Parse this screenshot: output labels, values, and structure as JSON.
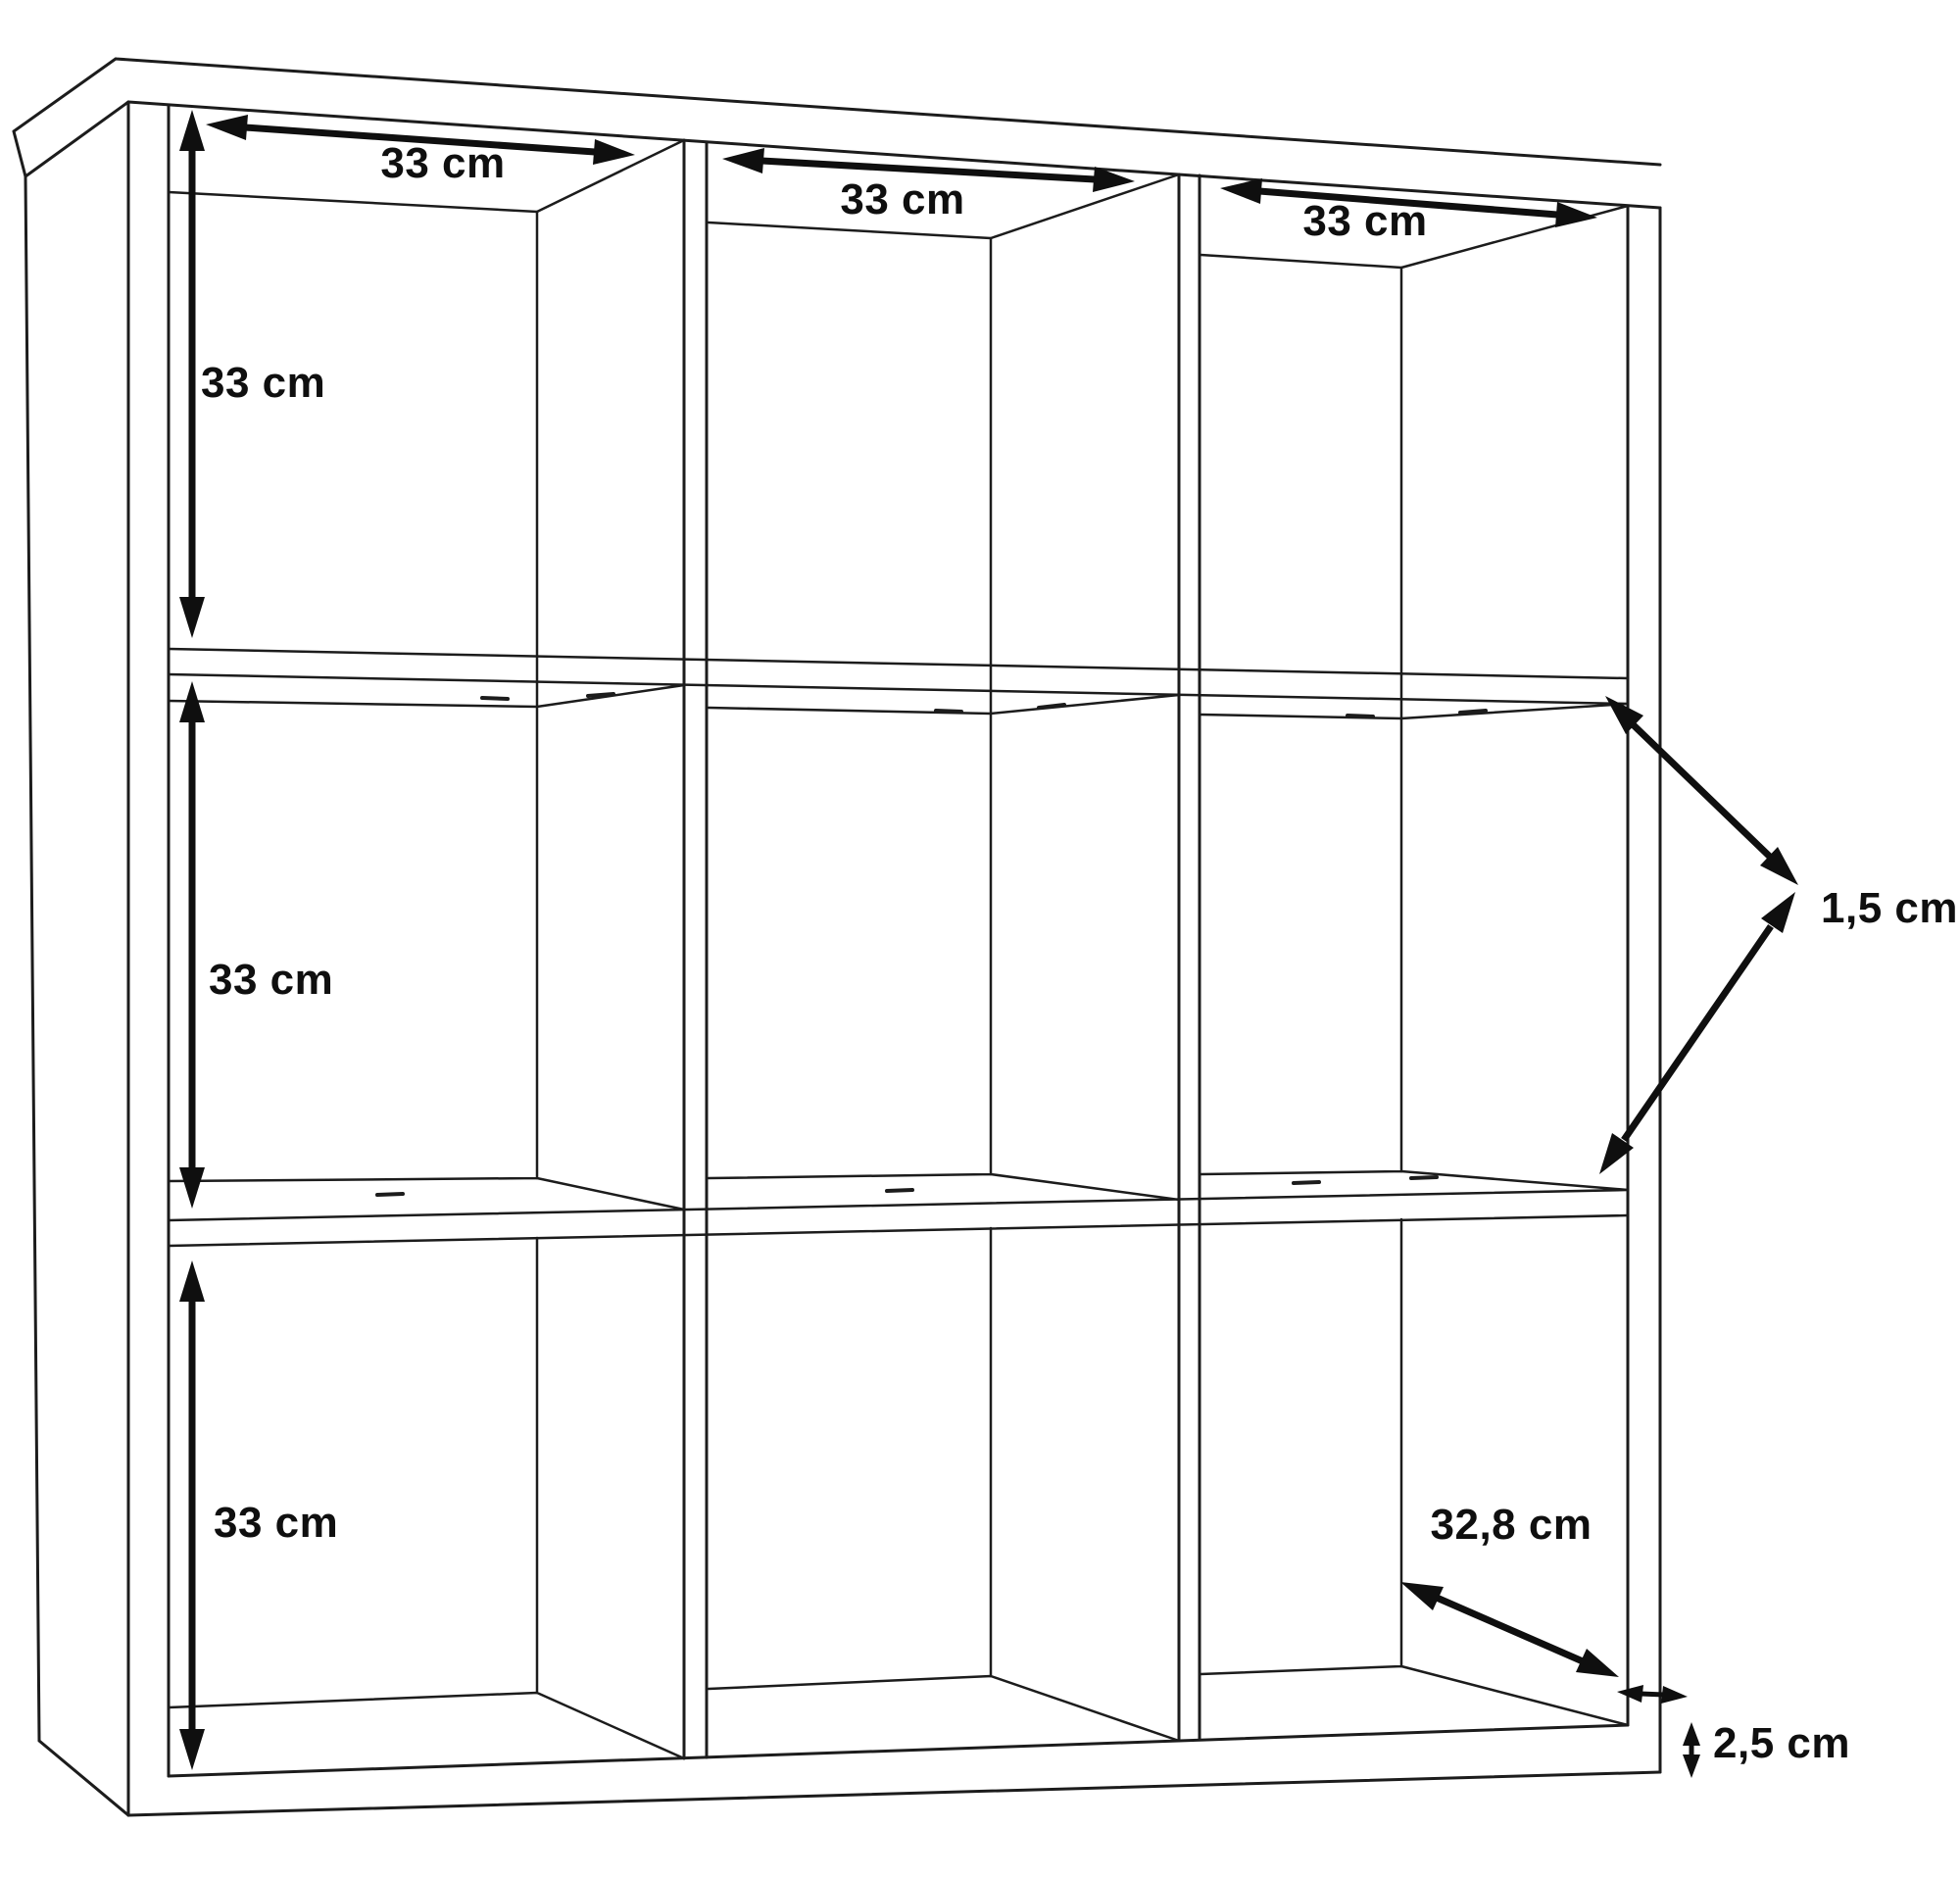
{
  "diagram": {
    "name": "cube-storage-shelf-dimension-drawing",
    "unit": "cm",
    "grid": {
      "columns": 3,
      "rows": 3
    },
    "dimensions": {
      "col1_width": "33 cm",
      "col2_width": "33 cm",
      "col3_width": "33 cm",
      "row1_height": "33 cm",
      "row2_height": "33 cm",
      "row3_height": "33 cm",
      "shelf_thickness": "1,5 cm",
      "inner_depth": "32,8 cm",
      "panel_thickness": "2,5 cm"
    },
    "colors": {
      "background": "#ffffff",
      "line": "#1c1c1c",
      "text": "#0f0f0f"
    }
  }
}
